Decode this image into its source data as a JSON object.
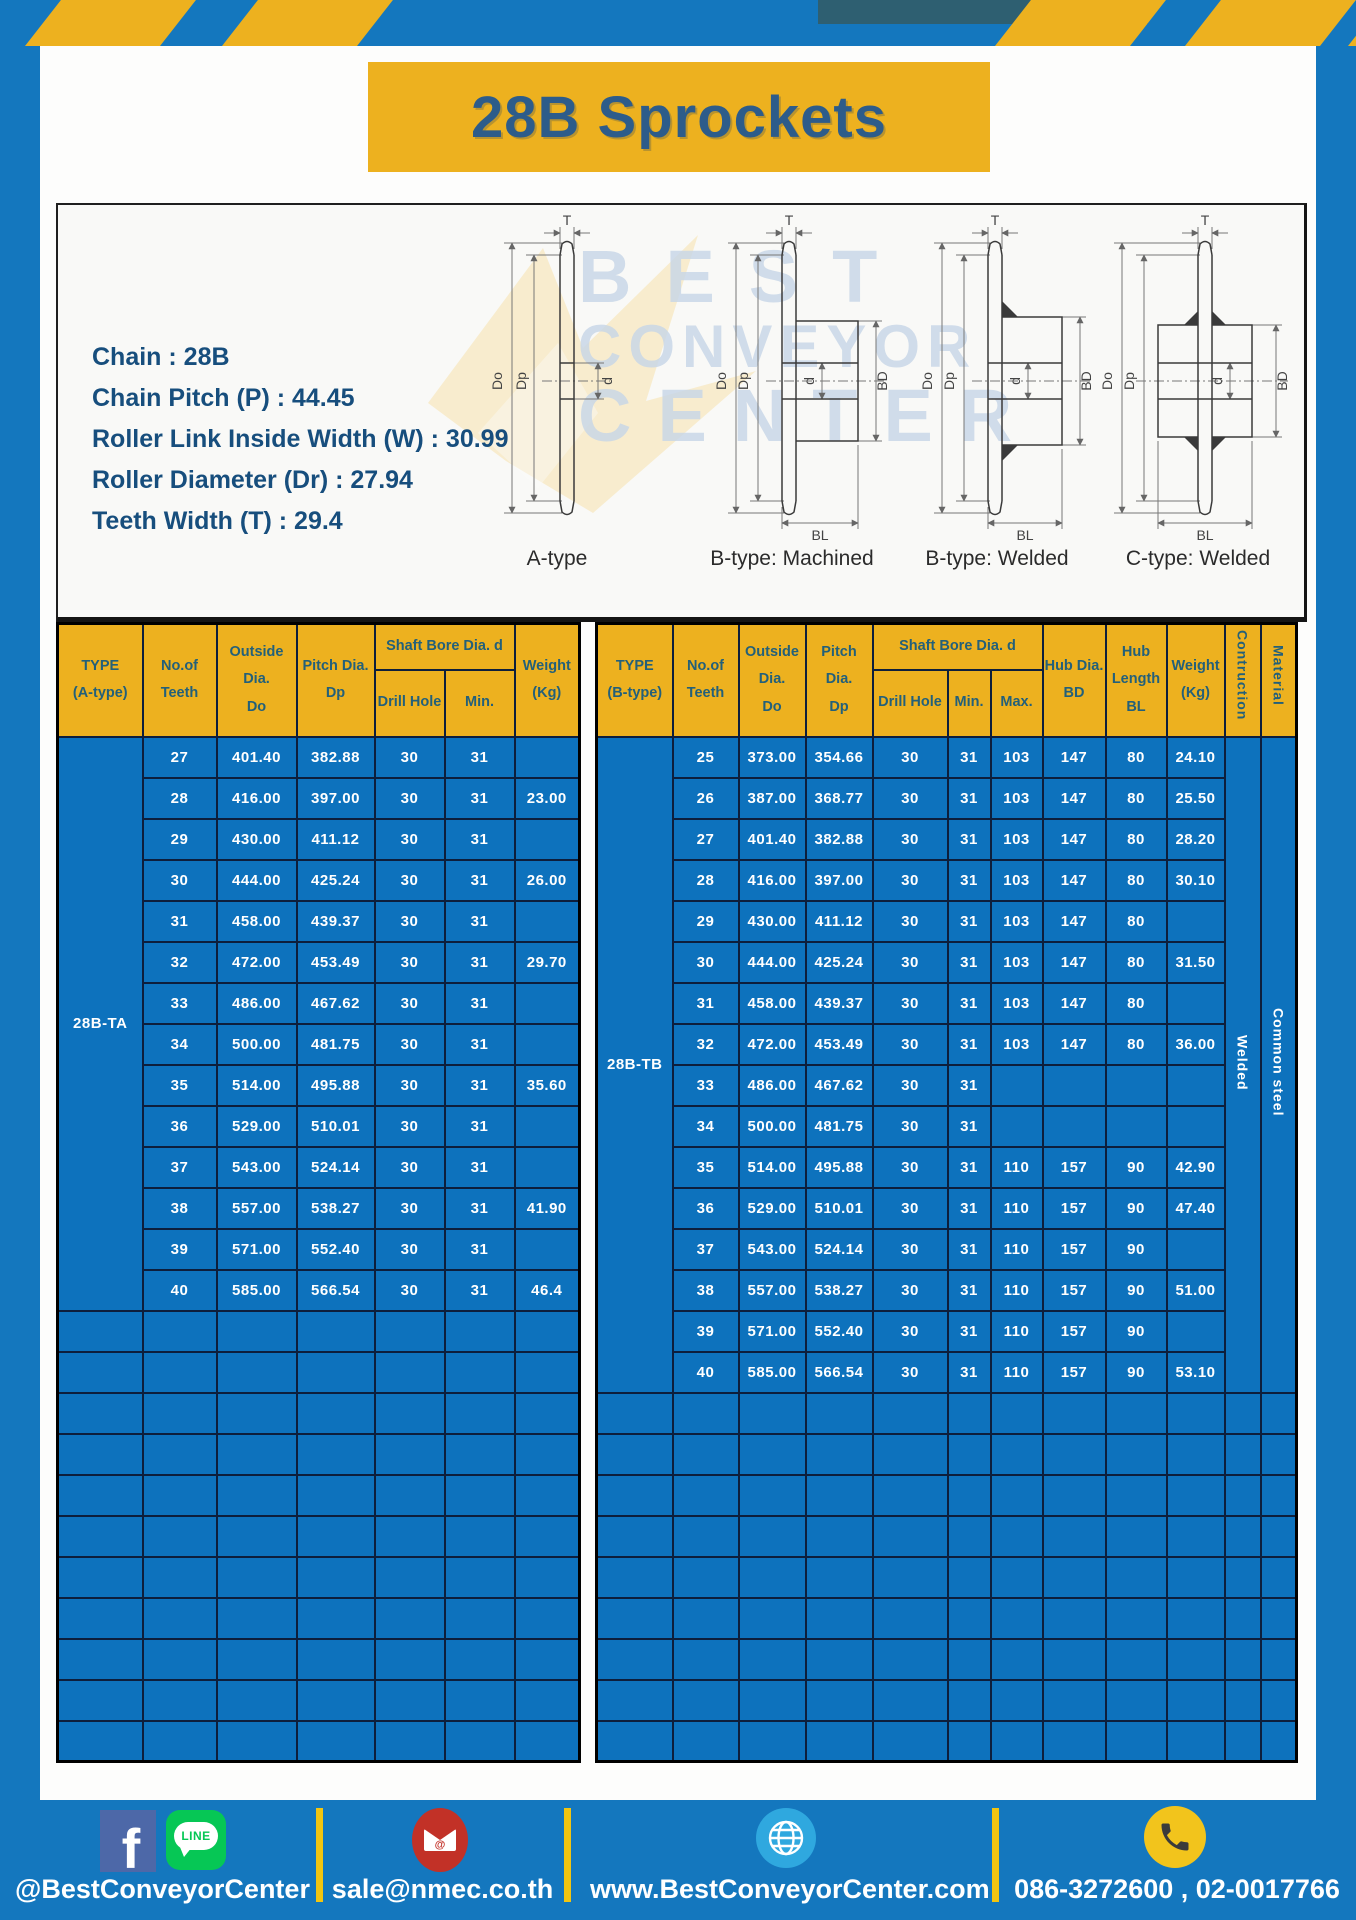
{
  "title": "28B Sprockets",
  "specs": [
    "Chain : 28B",
    "Chain Pitch (P) : 44.45",
    "Roller Link Inside Width (W) : 30.99",
    "Roller Diameter (Dr) : 27.94",
    "Teeth Width (T) : 29.4"
  ],
  "diagram": {
    "type_labels": [
      "A-type",
      "B-type: Machined",
      "B-type: Welded",
      "C-type: Welded"
    ],
    "dims": {
      "t": "T",
      "do": "Do",
      "dp": "Dp",
      "d": "d",
      "bd": "BD",
      "bl": "BL"
    },
    "watermark": [
      "BEST",
      "CONVEYOR",
      "CENTER"
    ]
  },
  "left_table": {
    "headers": {
      "type": "TYPE\n(A-type)",
      "teeth": "No.of\nTeeth",
      "outside": "Outside\nDia.\nDo",
      "pitch": "Pitch Dia.\nDp",
      "shaft_bore": "Shaft Bore Dia. d",
      "drill": "Drill Hole",
      "min": "Min.",
      "weight": "Weight\n(Kg)"
    },
    "group_label": "28B-TA",
    "rows": [
      [
        "27",
        "401.40",
        "382.88",
        "30",
        "31",
        ""
      ],
      [
        "28",
        "416.00",
        "397.00",
        "30",
        "31",
        "23.00"
      ],
      [
        "29",
        "430.00",
        "411.12",
        "30",
        "31",
        ""
      ],
      [
        "30",
        "444.00",
        "425.24",
        "30",
        "31",
        "26.00"
      ],
      [
        "31",
        "458.00",
        "439.37",
        "30",
        "31",
        ""
      ],
      [
        "32",
        "472.00",
        "453.49",
        "30",
        "31",
        "29.70"
      ],
      [
        "33",
        "486.00",
        "467.62",
        "30",
        "31",
        ""
      ],
      [
        "34",
        "500.00",
        "481.75",
        "30",
        "31",
        ""
      ],
      [
        "35",
        "514.00",
        "495.88",
        "30",
        "31",
        "35.60"
      ],
      [
        "36",
        "529.00",
        "510.01",
        "30",
        "31",
        ""
      ],
      [
        "37",
        "543.00",
        "524.14",
        "30",
        "31",
        ""
      ],
      [
        "38",
        "557.00",
        "538.27",
        "30",
        "31",
        "41.90"
      ],
      [
        "39",
        "571.00",
        "552.40",
        "30",
        "31",
        ""
      ],
      [
        "40",
        "585.00",
        "566.54",
        "30",
        "31",
        "46.4"
      ]
    ],
    "empty_rows": 11
  },
  "right_table": {
    "headers": {
      "type": "TYPE\n(B-type)",
      "teeth": "No.of\nTeeth",
      "outside": "Outside\nDia.\nDo",
      "pitch": "Pitch Dia.\nDp",
      "shaft_bore": "Shaft Bore Dia. d",
      "drill": "Drill Hole",
      "min": "Min.",
      "max": "Max.",
      "hub_dia": "Hub Dia.\nBD",
      "hub_len": "Hub\nLength\nBL",
      "weight": "Weight\n(Kg)",
      "construction": "Contruction",
      "material": "Material"
    },
    "group_label": "28B-TB",
    "construction_value": "Welded",
    "material_value": "Common steel",
    "rows": [
      [
        "25",
        "373.00",
        "354.66",
        "30",
        "31",
        "103",
        "147",
        "80",
        "24.10"
      ],
      [
        "26",
        "387.00",
        "368.77",
        "30",
        "31",
        "103",
        "147",
        "80",
        "25.50"
      ],
      [
        "27",
        "401.40",
        "382.88",
        "30",
        "31",
        "103",
        "147",
        "80",
        "28.20"
      ],
      [
        "28",
        "416.00",
        "397.00",
        "30",
        "31",
        "103",
        "147",
        "80",
        "30.10"
      ],
      [
        "29",
        "430.00",
        "411.12",
        "30",
        "31",
        "103",
        "147",
        "80",
        ""
      ],
      [
        "30",
        "444.00",
        "425.24",
        "30",
        "31",
        "103",
        "147",
        "80",
        "31.50"
      ],
      [
        "31",
        "458.00",
        "439.37",
        "30",
        "31",
        "103",
        "147",
        "80",
        ""
      ],
      [
        "32",
        "472.00",
        "453.49",
        "30",
        "31",
        "103",
        "147",
        "80",
        "36.00"
      ],
      [
        "33",
        "486.00",
        "467.62",
        "30",
        "31",
        "",
        "",
        "",
        ""
      ],
      [
        "34",
        "500.00",
        "481.75",
        "30",
        "31",
        "",
        "",
        "",
        ""
      ],
      [
        "35",
        "514.00",
        "495.88",
        "30",
        "31",
        "110",
        "157",
        "90",
        "42.90"
      ],
      [
        "36",
        "529.00",
        "510.01",
        "30",
        "31",
        "110",
        "157",
        "90",
        "47.40"
      ],
      [
        "37",
        "543.00",
        "524.14",
        "30",
        "31",
        "110",
        "157",
        "90",
        ""
      ],
      [
        "38",
        "557.00",
        "538.27",
        "30",
        "31",
        "110",
        "157",
        "90",
        "51.00"
      ],
      [
        "39",
        "571.00",
        "552.40",
        "30",
        "31",
        "110",
        "157",
        "90",
        ""
      ],
      [
        "40",
        "585.00",
        "566.54",
        "30",
        "31",
        "110",
        "157",
        "90",
        "53.10"
      ]
    ],
    "empty_rows": 9
  },
  "footer": {
    "social_label": "@BestConveyorCenter",
    "email_label": "sale@nmec.co.th",
    "website_label": "www.BestConveyorCenter.com",
    "phone_label": "086-3272600 , 02-0017766",
    "line_badge": "LINE",
    "facebook_glyph": "f",
    "email_at_glyph": "@"
  },
  "colors": {
    "page_blue": "#1477BE",
    "cell_blue": "#0D72BD",
    "accent_yellow": "#EDB11F",
    "header_text": "#23607A",
    "grid_line": "#0D1E3C",
    "title_text": "#2D5C8A",
    "line_green": "#06C755",
    "facebook_blue": "#4D68A8",
    "email_red": "#C23127",
    "globe_blue": "#2FA8DF",
    "phone_yellow": "#F2C41C"
  }
}
